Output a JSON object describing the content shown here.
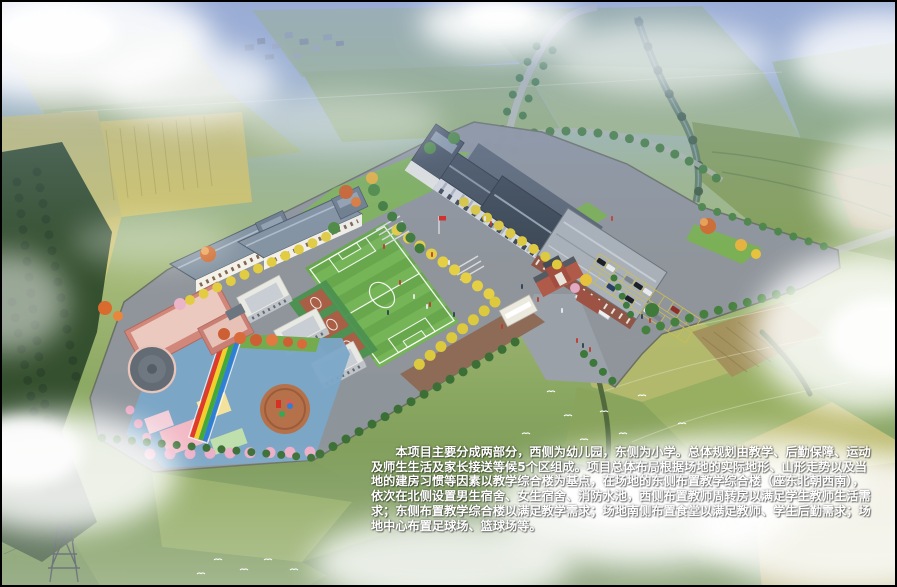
{
  "caption": {
    "lines": [
      "　　本项目主要分成两部分，西侧为幼儿园，东侧为小学。总体规划由教学、后勤保障、运动",
      "及师生生活及家长接送等候5个区组成。项目总体布局根据场地的实际地形、山形走势以及当",
      "地的建房习惯等因素以教学综合楼为基点，在场地的东侧布置教学综合楼（座东北朝西南），",
      "依次在北侧设置男生宿舍、女生宿舍、消防水池，西侧布置教师周转房以满足学生教师生活需",
      "求；东侧布置教学综合楼以满足教学需求；场地南侧布置食堂以满足教师、学生后勤需求；场",
      "地中心布置足球场、篮球场等。"
    ],
    "full_text": "本项目主要分成两部分，西侧为幼儿园，东侧为小学。总体规划由教学、后勤保障、运动及师生生活及家长接送等候5个区组成。项目总体布局根据场地的实际地形、山形走势以及当地的建房习惯等因素以教学综合楼为基点，在场地的东侧布置教学综合楼（座东北朝西南），依次在北侧设置男生宿舍、女生宿舍、消防水池，西侧布置教师周转房以满足学生教师生活需求；东侧布置教学综合楼以满足教学需求；场地南侧布置食堂以满足教师、学生后勤需求；场地中心布置足球场、篮球场等。"
  },
  "landmarks": {
    "teaching_building": "教学综合楼",
    "canteen": "食堂",
    "football_field": "足球场",
    "basketball_courts": "篮球场",
    "kindergarten": "幼儿园",
    "dormitories": "男生宿舍、女生宿舍",
    "teacher_housing": "教师周转房",
    "parking_lot": "家长接送等候区",
    "entrance_gate": "学校大门"
  },
  "palette": {
    "sky_haze": "#a9bcd9",
    "farmland_green": "#9db86e",
    "farmland_yellow": "#d2c56a",
    "forest_green": "#35502f",
    "plaza_gray": "#8f959c",
    "field_green": "#68a74c",
    "field_stripe": "#76b458",
    "walkway_brown": "#8d6b57",
    "roof_slate": "#434f5b",
    "canteen_roof": "#a9b0b8",
    "dorm_roof": "#8493a1",
    "wall_white": "#f3f1e8",
    "kindergarten_pink": "#d2877b",
    "kindergarten_roof": "#ecc9bf",
    "playground_blue": "#7ba7c8",
    "rainbow_colors": [
      "#e03a2a",
      "#f2cf2a",
      "#43a938",
      "#2f7fd6"
    ],
    "ginkgo_yellow": "#e4cf45",
    "tree_green": "#46803e",
    "blossom_pink": "#edaec8",
    "flag_red": "#d5281e",
    "cloud_white": "#ffffff",
    "caption_color": "#ffffff"
  }
}
